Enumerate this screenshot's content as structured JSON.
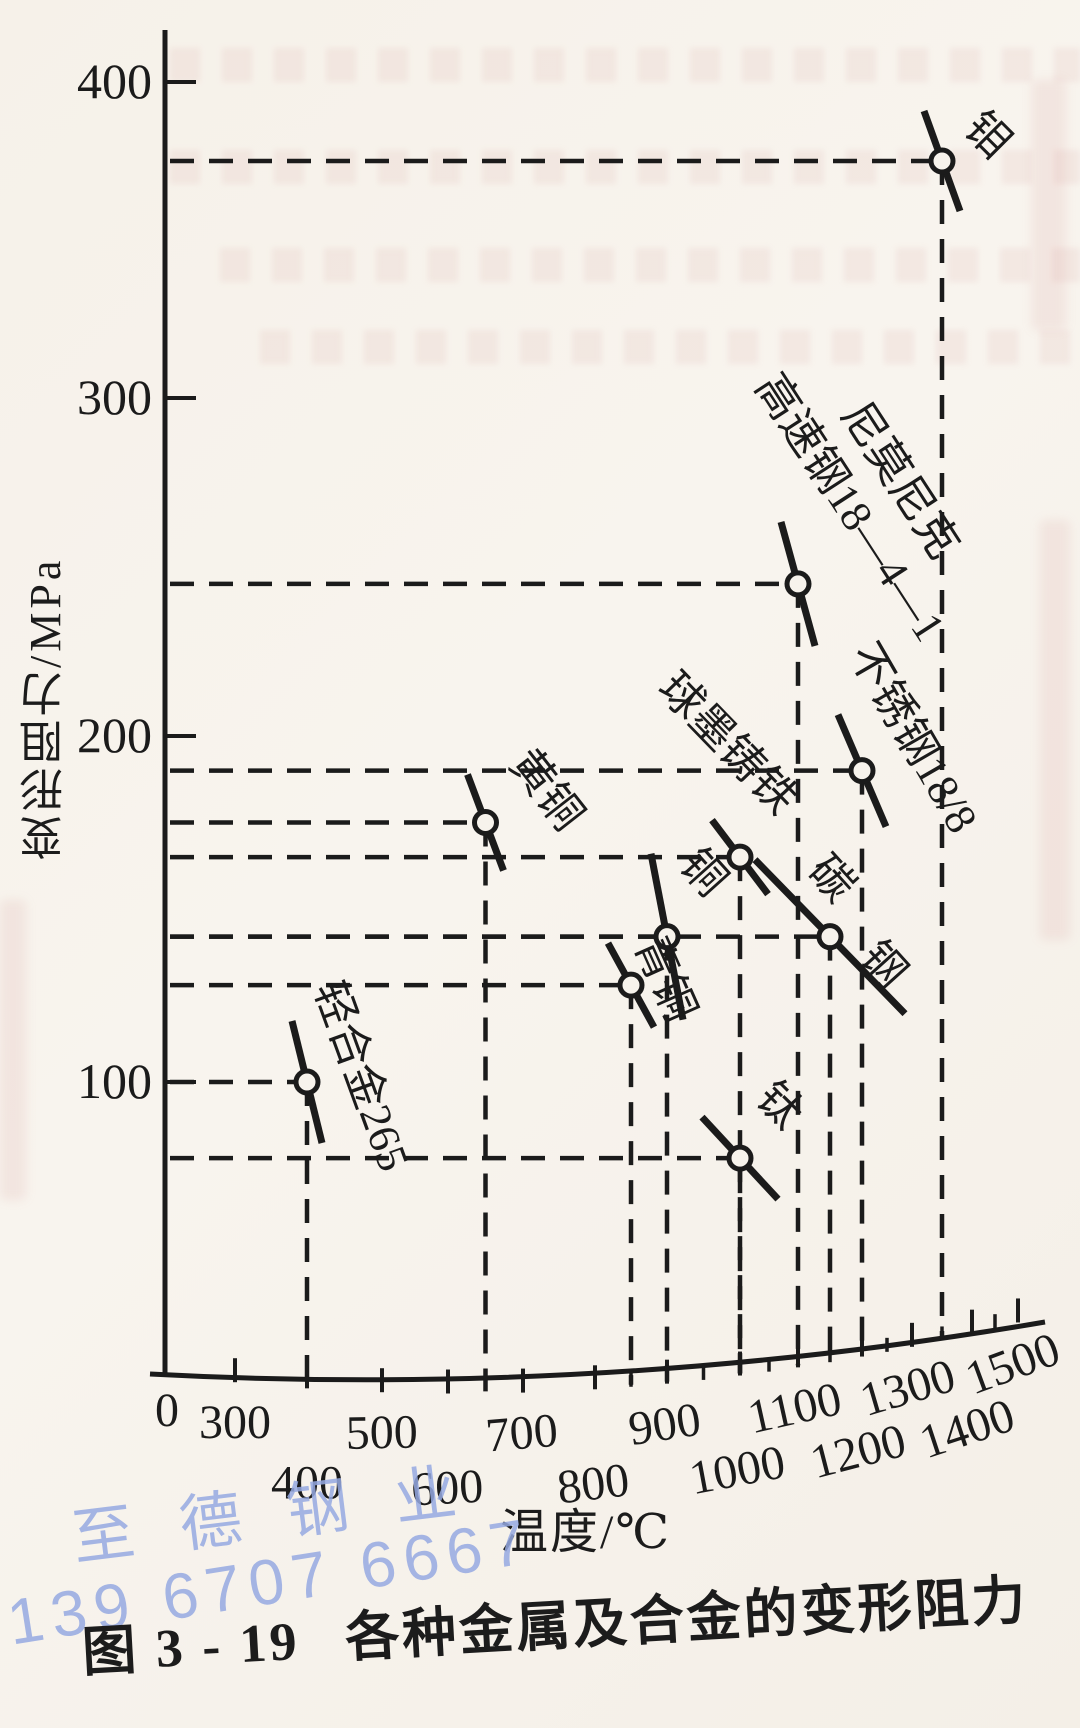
{
  "figure": {
    "caption_number": "图 3 - 19",
    "caption_title": "各种金属及合金的变形阻力",
    "y_axis_title": "变形阻力/MPa",
    "x_axis_title": "温度/℃"
  },
  "watermark": {
    "name": "至德钢业",
    "phone": "139 6707 6667",
    "color": "#96aae2"
  },
  "chart_data": {
    "type": "scatter",
    "title": "各种金属及合金的变形阻力",
    "xlabel": "温度/℃",
    "ylabel": "变形阻力/MPa",
    "x_tick_labels_row1": [
      "0",
      "300",
      "500",
      "700",
      "900",
      "1100",
      "1300",
      "1500"
    ],
    "x_tick_labels_row2": [
      "400",
      "600",
      "800",
      "1000",
      "1200",
      "1400"
    ],
    "y_tick_labels": [
      "100",
      "200",
      "300",
      "400"
    ],
    "x_major_ticks": [
      300,
      400,
      500,
      600,
      700,
      800,
      900,
      1000,
      1100,
      1200,
      1300,
      1400,
      1500
    ],
    "x_minor_ticks": [
      850,
      950,
      1050,
      1150,
      1250,
      1350,
      1450
    ],
    "y_major_ticks": [
      100,
      200,
      300,
      400
    ],
    "xlim": [
      300,
      1500
    ],
    "ylim": [
      0,
      420
    ],
    "grid": "dashed guide lines from each point to both axes",
    "legend_position": "labels beside points",
    "points": [
      {
        "label": "钼",
        "temp_c": 1350,
        "resistance_mpa": 375
      },
      {
        "label": "尼莫尼克",
        "label2": "高速钢18—4—1",
        "temp_c": 1100,
        "resistance_mpa": 245
      },
      {
        "label": "不锈钢18/8",
        "temp_c": 1200,
        "resistance_mpa": 190
      },
      {
        "label": "黄铜",
        "temp_c": 650,
        "resistance_mpa": 175
      },
      {
        "label": "球墨铸铁",
        "temp_c": 1000,
        "resistance_mpa": 165
      },
      {
        "label": "碳钢",
        "temp_c": 1150,
        "resistance_mpa": 142
      },
      {
        "label": "铜",
        "temp_c": 900,
        "resistance_mpa": 142
      },
      {
        "label": "青铜",
        "temp_c": 850,
        "resistance_mpa": 128
      },
      {
        "label": "轻合金265",
        "temp_c": 400,
        "resistance_mpa": 100
      },
      {
        "label": "钛",
        "temp_c": 1000,
        "resistance_mpa": 78
      }
    ]
  }
}
